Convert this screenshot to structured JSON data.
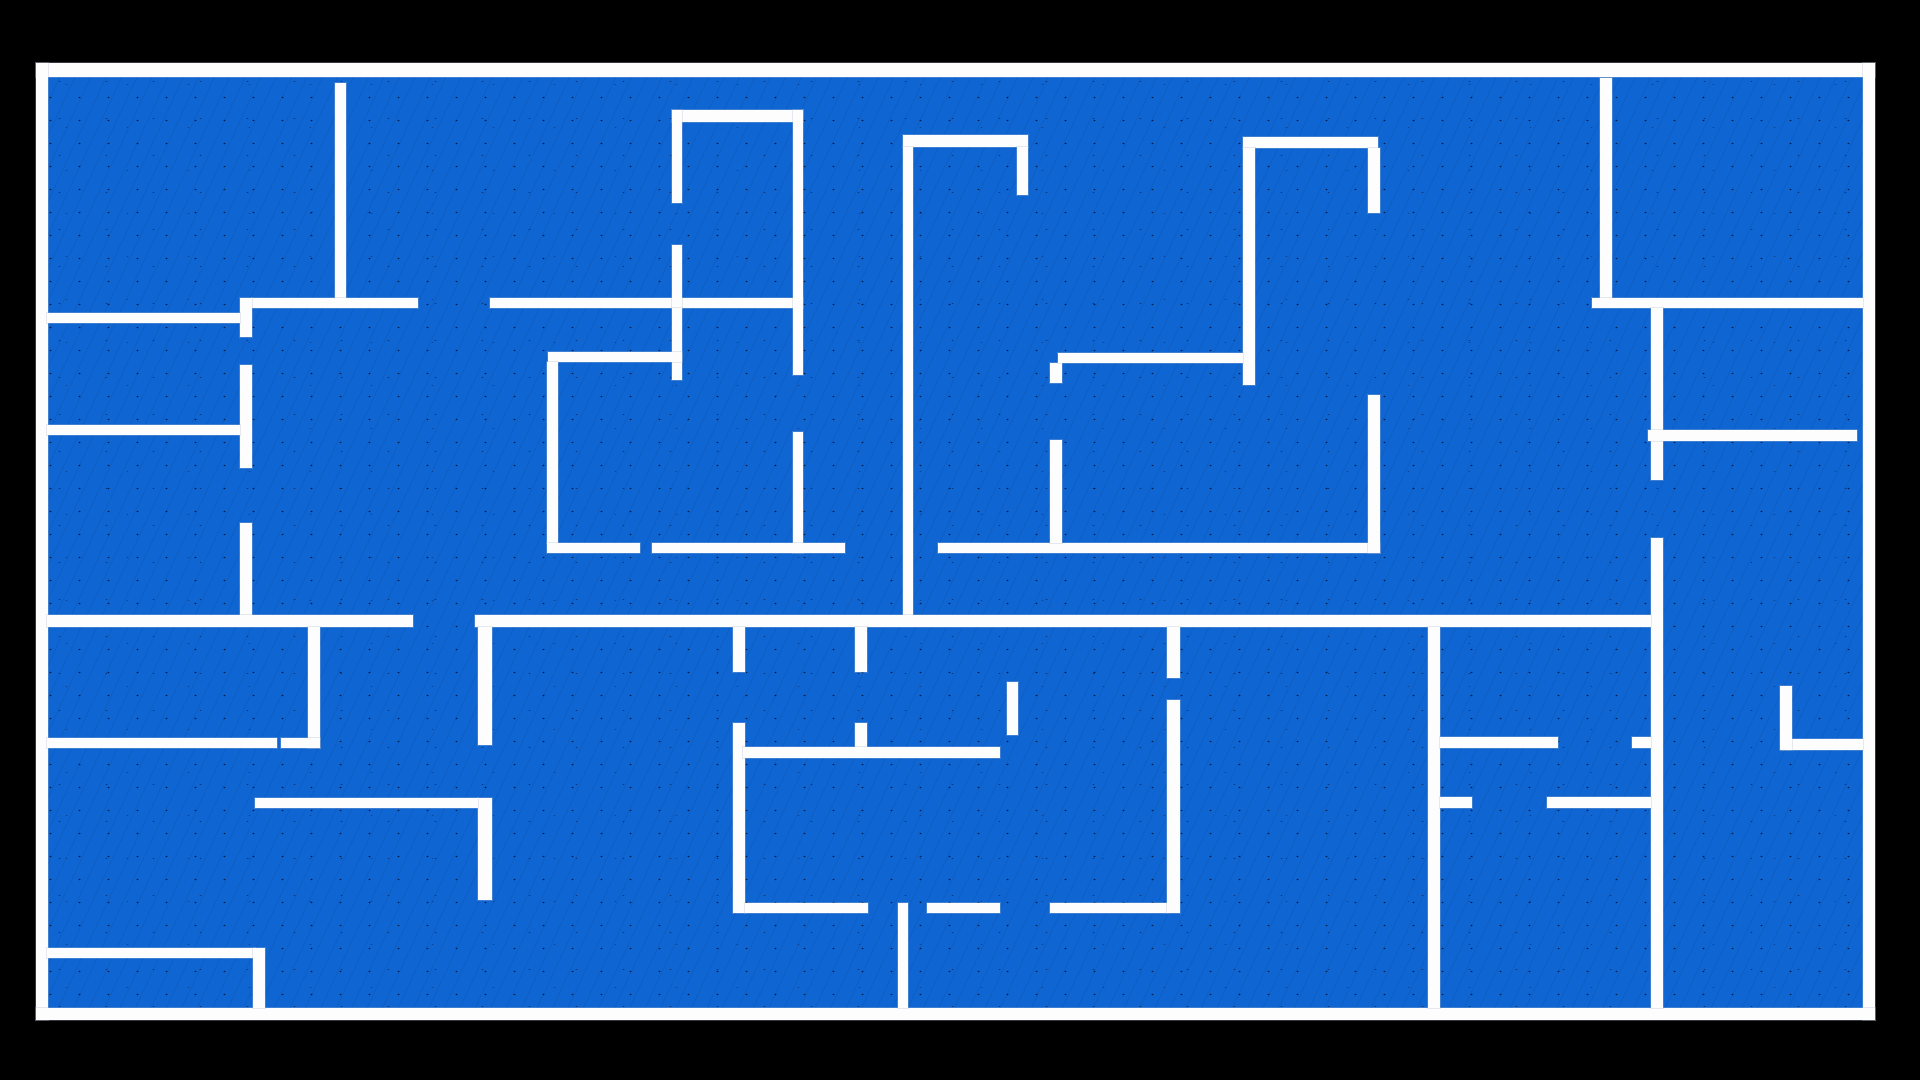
{
  "meta": {
    "description": "Blueprint-style floor plan: blue floor with white walls on a black background, no text.",
    "background_color": "#000000",
    "floor_color": "#0f66d3",
    "wall_color": "#fdfdfd",
    "noise_color": "#04123c"
  },
  "canvas": {
    "width": 1920,
    "height": 1080
  },
  "floor_area": {
    "x": 36,
    "y": 63,
    "w": 1839,
    "h": 957
  },
  "border_walls": [
    {
      "name": "border-top",
      "x": 36,
      "y": 63,
      "w": 1839,
      "h": 14
    },
    {
      "name": "border-left",
      "x": 36,
      "y": 63,
      "w": 12,
      "h": 957
    },
    {
      "name": "border-right",
      "x": 1863,
      "y": 63,
      "w": 12,
      "h": 957
    },
    {
      "name": "border-bottom",
      "x": 36,
      "y": 1008,
      "w": 1839,
      "h": 12
    }
  ],
  "walls": [
    {
      "x": 335,
      "y": 83,
      "w": 11,
      "h": 215
    },
    {
      "x": 252,
      "y": 298,
      "w": 166,
      "h": 10
    },
    {
      "x": 240,
      "y": 298,
      "w": 12,
      "h": 39
    },
    {
      "x": 47,
      "y": 313,
      "w": 193,
      "h": 10
    },
    {
      "x": 240,
      "y": 365,
      "w": 12,
      "h": 103
    },
    {
      "x": 240,
      "y": 523,
      "w": 12,
      "h": 92
    },
    {
      "x": 47,
      "y": 425,
      "w": 193,
      "h": 10
    },
    {
      "x": 490,
      "y": 298,
      "w": 313,
      "h": 10
    },
    {
      "x": 672,
      "y": 110,
      "w": 131,
      "h": 12
    },
    {
      "x": 672,
      "y": 110,
      "w": 10,
      "h": 93
    },
    {
      "x": 672,
      "y": 245,
      "w": 10,
      "h": 63
    },
    {
      "x": 793,
      "y": 110,
      "w": 10,
      "h": 265
    },
    {
      "x": 793,
      "y": 432,
      "w": 10,
      "h": 121
    },
    {
      "x": 672,
      "y": 308,
      "w": 10,
      "h": 72
    },
    {
      "x": 548,
      "y": 352,
      "w": 134,
      "h": 10
    },
    {
      "x": 547,
      "y": 362,
      "w": 11,
      "h": 181
    },
    {
      "x": 547,
      "y": 543,
      "w": 93,
      "h": 10
    },
    {
      "x": 652,
      "y": 543,
      "w": 193,
      "h": 10
    },
    {
      "x": 938,
      "y": 543,
      "w": 442,
      "h": 10
    },
    {
      "x": 1050,
      "y": 363,
      "w": 12,
      "h": 20
    },
    {
      "x": 1050,
      "y": 440,
      "w": 12,
      "h": 103
    },
    {
      "x": 903,
      "y": 135,
      "w": 125,
      "h": 12
    },
    {
      "x": 1017,
      "y": 147,
      "w": 11,
      "h": 48
    },
    {
      "x": 903,
      "y": 147,
      "w": 10,
      "h": 468
    },
    {
      "x": 1243,
      "y": 137,
      "w": 135,
      "h": 11
    },
    {
      "x": 1368,
      "y": 148,
      "w": 12,
      "h": 65
    },
    {
      "x": 1243,
      "y": 148,
      "w": 12,
      "h": 237
    },
    {
      "x": 1058,
      "y": 353,
      "w": 185,
      "h": 10
    },
    {
      "x": 1368,
      "y": 395,
      "w": 12,
      "h": 158
    },
    {
      "x": 1600,
      "y": 78,
      "w": 12,
      "h": 220
    },
    {
      "x": 1592,
      "y": 298,
      "w": 271,
      "h": 10
    },
    {
      "x": 1651,
      "y": 308,
      "w": 12,
      "h": 172
    },
    {
      "x": 1651,
      "y": 538,
      "w": 12,
      "h": 470
    },
    {
      "x": 1648,
      "y": 430,
      "w": 209,
      "h": 11
    },
    {
      "x": 47,
      "y": 615,
      "w": 366,
      "h": 12
    },
    {
      "x": 475,
      "y": 615,
      "w": 1176,
      "h": 12
    },
    {
      "x": 308,
      "y": 627,
      "w": 12,
      "h": 121
    },
    {
      "x": 47,
      "y": 738,
      "w": 230,
      "h": 10
    },
    {
      "x": 281,
      "y": 738,
      "w": 39,
      "h": 10
    },
    {
      "x": 478,
      "y": 627,
      "w": 14,
      "h": 118
    },
    {
      "x": 478,
      "y": 798,
      "w": 14,
      "h": 102
    },
    {
      "x": 255,
      "y": 798,
      "w": 223,
      "h": 10
    },
    {
      "x": 47,
      "y": 948,
      "w": 208,
      "h": 10
    },
    {
      "x": 253,
      "y": 948,
      "w": 12,
      "h": 60
    },
    {
      "x": 733,
      "y": 627,
      "w": 12,
      "h": 45
    },
    {
      "x": 733,
      "y": 723,
      "w": 12,
      "h": 190
    },
    {
      "x": 855,
      "y": 627,
      "w": 12,
      "h": 45
    },
    {
      "x": 855,
      "y": 723,
      "w": 12,
      "h": 24
    },
    {
      "x": 743,
      "y": 747,
      "w": 257,
      "h": 11
    },
    {
      "x": 1007,
      "y": 682,
      "w": 11,
      "h": 53
    },
    {
      "x": 745,
      "y": 903,
      "w": 123,
      "h": 10
    },
    {
      "x": 927,
      "y": 903,
      "w": 73,
      "h": 10
    },
    {
      "x": 1050,
      "y": 903,
      "w": 118,
      "h": 10
    },
    {
      "x": 898,
      "y": 903,
      "w": 10,
      "h": 105
    },
    {
      "x": 1167,
      "y": 627,
      "w": 13,
      "h": 51
    },
    {
      "x": 1167,
      "y": 700,
      "w": 13,
      "h": 213
    },
    {
      "x": 1428,
      "y": 627,
      "w": 12,
      "h": 381
    },
    {
      "x": 1440,
      "y": 737,
      "w": 118,
      "h": 11
    },
    {
      "x": 1632,
      "y": 737,
      "w": 19,
      "h": 11
    },
    {
      "x": 1782,
      "y": 739,
      "w": 81,
      "h": 11
    },
    {
      "x": 1440,
      "y": 797,
      "w": 32,
      "h": 11
    },
    {
      "x": 1547,
      "y": 797,
      "w": 104,
      "h": 11
    },
    {
      "x": 1780,
      "y": 686,
      "w": 12,
      "h": 64
    }
  ]
}
